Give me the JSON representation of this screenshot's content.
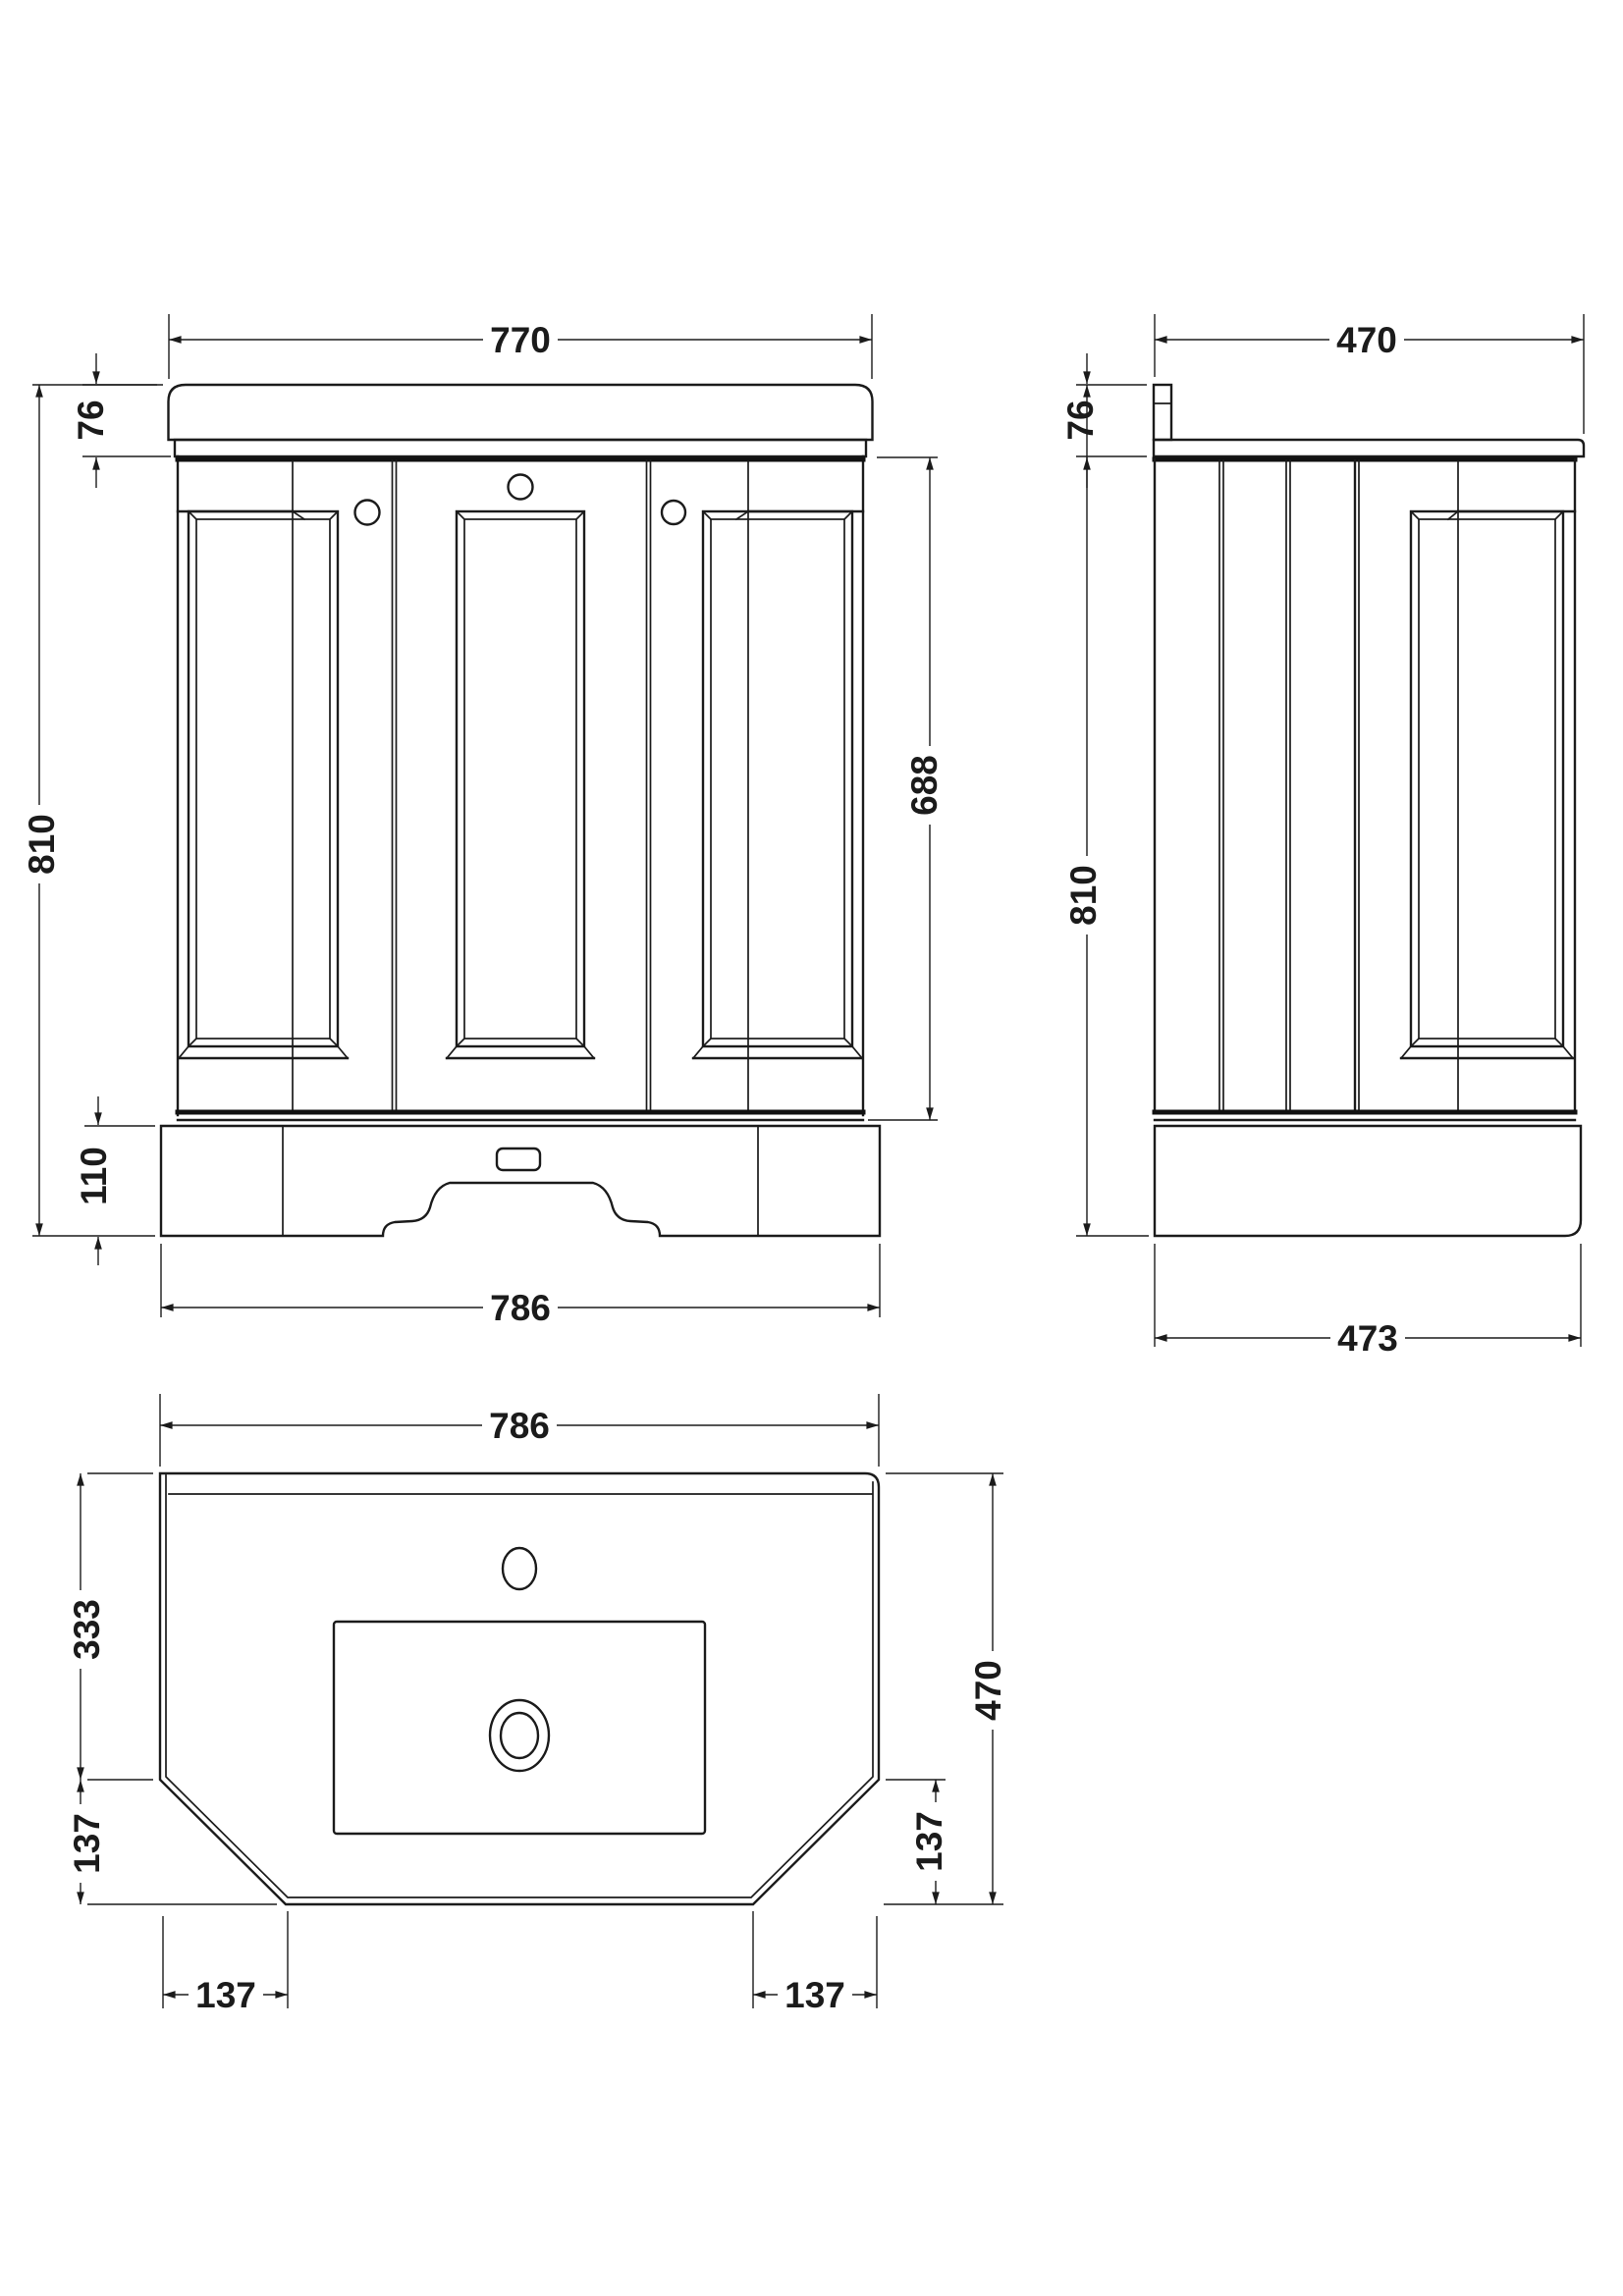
{
  "drawing": {
    "product": "bathroom vanity unit with basin - dimension drawing",
    "units": "mm",
    "line_color": "#1b1b1b",
    "background": "#ffffff"
  },
  "front_view": {
    "dims": {
      "width_top": "770",
      "counter_height": "76",
      "height_total": "810",
      "cabinet_height": "688",
      "plinth_height": "110",
      "width_bottom": "786"
    }
  },
  "side_view": {
    "dims": {
      "depth_top": "470",
      "counter_height": "76",
      "height_total": "810",
      "depth_bottom": "473"
    }
  },
  "plan_view": {
    "dims": {
      "width_top": "786",
      "basin_back_depth": "333",
      "chamfer_left_vertical": "137",
      "chamfer_left_horizontal": "137",
      "depth_total": "470",
      "chamfer_right_vertical": "137",
      "chamfer_right_horizontal": "137"
    }
  }
}
